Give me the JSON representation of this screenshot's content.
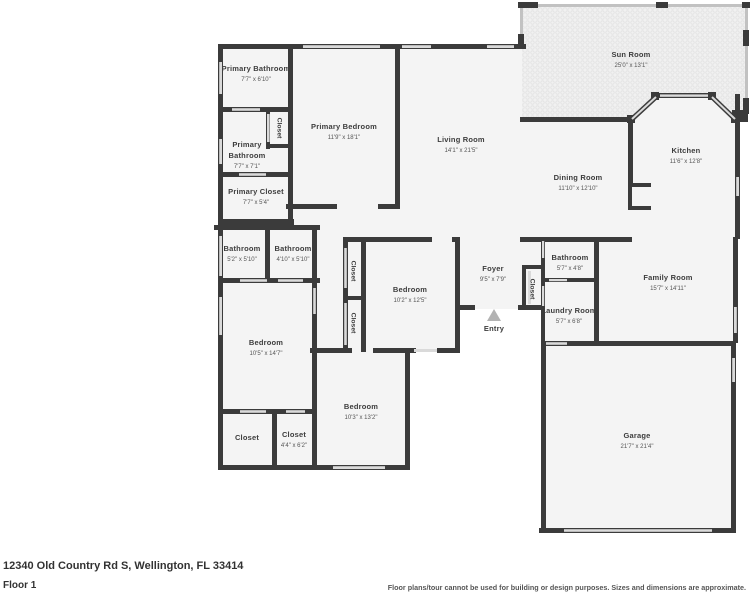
{
  "footer": {
    "address": "12340 Old Country Rd S, Wellington, FL 33414",
    "floor": "Floor 1",
    "disclaimer": "Floor plans/tour cannot be used for building or design purposes. Sizes and dimensions are approximate."
  },
  "colors": {
    "wall": "#3b3b3b",
    "floor": "#f4f4f4",
    "window": "#dadada",
    "sun_room_screen": "#c2c2c2",
    "entry_arrow": "#b3b3b3",
    "label_text": "#3d3d3d"
  },
  "plan": {
    "rooms": [
      {
        "label": "Primary Bathroom",
        "dims": "7'7\" x 6'10\"",
        "x": 256,
        "y": 71
      },
      {
        "label": "Primary Bathroom",
        "dims": "7'7\" x 7'1\"",
        "x": 247,
        "y": 147,
        "wrap": true
      },
      {
        "label": "Closet",
        "x": 280,
        "y": 128,
        "vertical": true
      },
      {
        "label": "Primary Closet",
        "dims": "7'7\" x 5'4\"",
        "x": 256,
        "y": 194
      },
      {
        "label": "Primary Bedroom",
        "dims": "11'9\" x 18'1\"",
        "x": 344,
        "y": 129
      },
      {
        "label": "Living Room",
        "dims": "14'1\" x 21'5\"",
        "x": 461,
        "y": 142
      },
      {
        "label": "Sun Room",
        "dims": "25'0\" x 13'1\"",
        "x": 631,
        "y": 57
      },
      {
        "label": "Kitchen",
        "dims": "11'6\" x 12'8\"",
        "x": 686,
        "y": 153
      },
      {
        "label": "Dining Room",
        "dims": "11'10\" x 12'10\"",
        "x": 578,
        "y": 180
      },
      {
        "label": "Bathroom",
        "dims": "5'2\" x 5'10\"",
        "x": 242,
        "y": 251
      },
      {
        "label": "Bathroom",
        "dims": "4'10\" x 5'10\"",
        "x": 293,
        "y": 251
      },
      {
        "label": "Closet",
        "x": 354,
        "y": 271,
        "vertical": true
      },
      {
        "label": "Closet",
        "x": 354,
        "y": 323,
        "vertical": true
      },
      {
        "label": "Bedroom",
        "dims": "10'2\" x 12'5\"",
        "x": 410,
        "y": 292
      },
      {
        "label": "Foyer",
        "dims": "9'5\" x 7'9\"",
        "x": 493,
        "y": 271
      },
      {
        "label": "Closet",
        "x": 533,
        "y": 289,
        "vertical": true
      },
      {
        "label": "Bathroom",
        "dims": "5'7\" x 4'8\"",
        "x": 570,
        "y": 260
      },
      {
        "label": "Family Room",
        "dims": "15'7\" x 14'11\"",
        "x": 668,
        "y": 280
      },
      {
        "label": "Laundry Room",
        "dims": "5'7\" x 6'8\"",
        "x": 569,
        "y": 313
      },
      {
        "label": "Entry",
        "x": 494,
        "y": 331
      },
      {
        "label": "Bedroom",
        "dims": "10'5\" x 14'7\"",
        "x": 266,
        "y": 345
      },
      {
        "label": "Bedroom",
        "dims": "10'3\" x 13'2\"",
        "x": 361,
        "y": 409
      },
      {
        "label": "Closet",
        "x": 247,
        "y": 440
      },
      {
        "label": "Closet",
        "dims": "4'4\" x 6'2\"",
        "x": 294,
        "y": 437
      },
      {
        "label": "Garage",
        "dims": "21'7\" x 21'4\"",
        "x": 637,
        "y": 438
      }
    ]
  }
}
